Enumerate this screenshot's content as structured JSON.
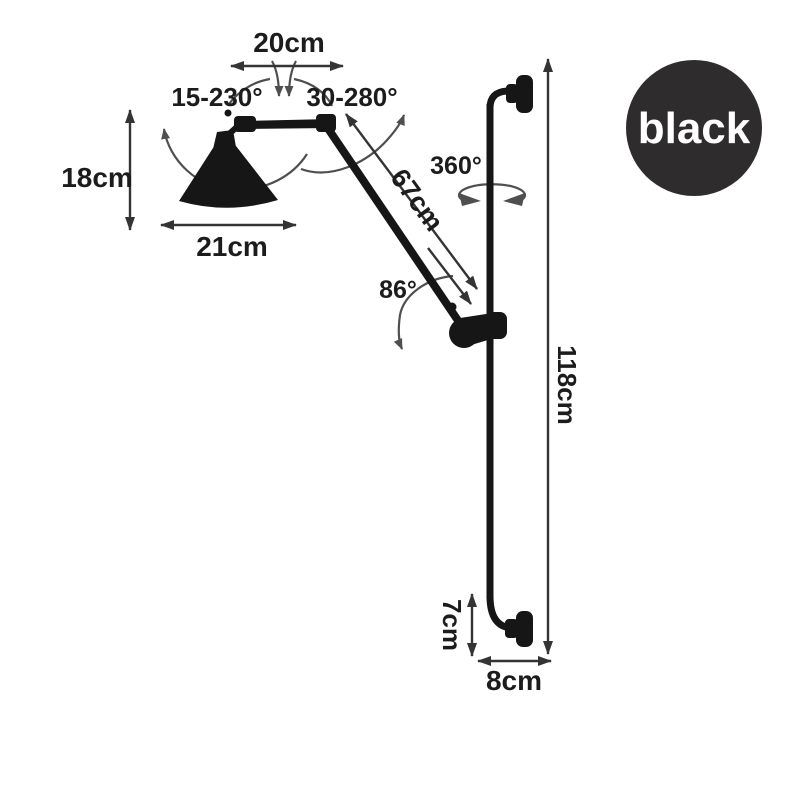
{
  "badge": {
    "label": "black",
    "bg": "#2e2c2c",
    "fg": "#ffffff"
  },
  "labels": {
    "top_width": "20cm",
    "shade_rotation": "15-230°",
    "arm_rotation": "30-280°",
    "shade_height": "18cm",
    "shade_diameter": "21cm",
    "arm_length": "67cm",
    "swivel": "360°",
    "elbow_angle": "86°",
    "pole_height": "118cm",
    "base_height": "7cm",
    "base_depth": "8cm"
  },
  "colors": {
    "drawing": "#161616",
    "dimension": "#343434",
    "arc": "#4f4f4f",
    "background": "#ffffff"
  }
}
